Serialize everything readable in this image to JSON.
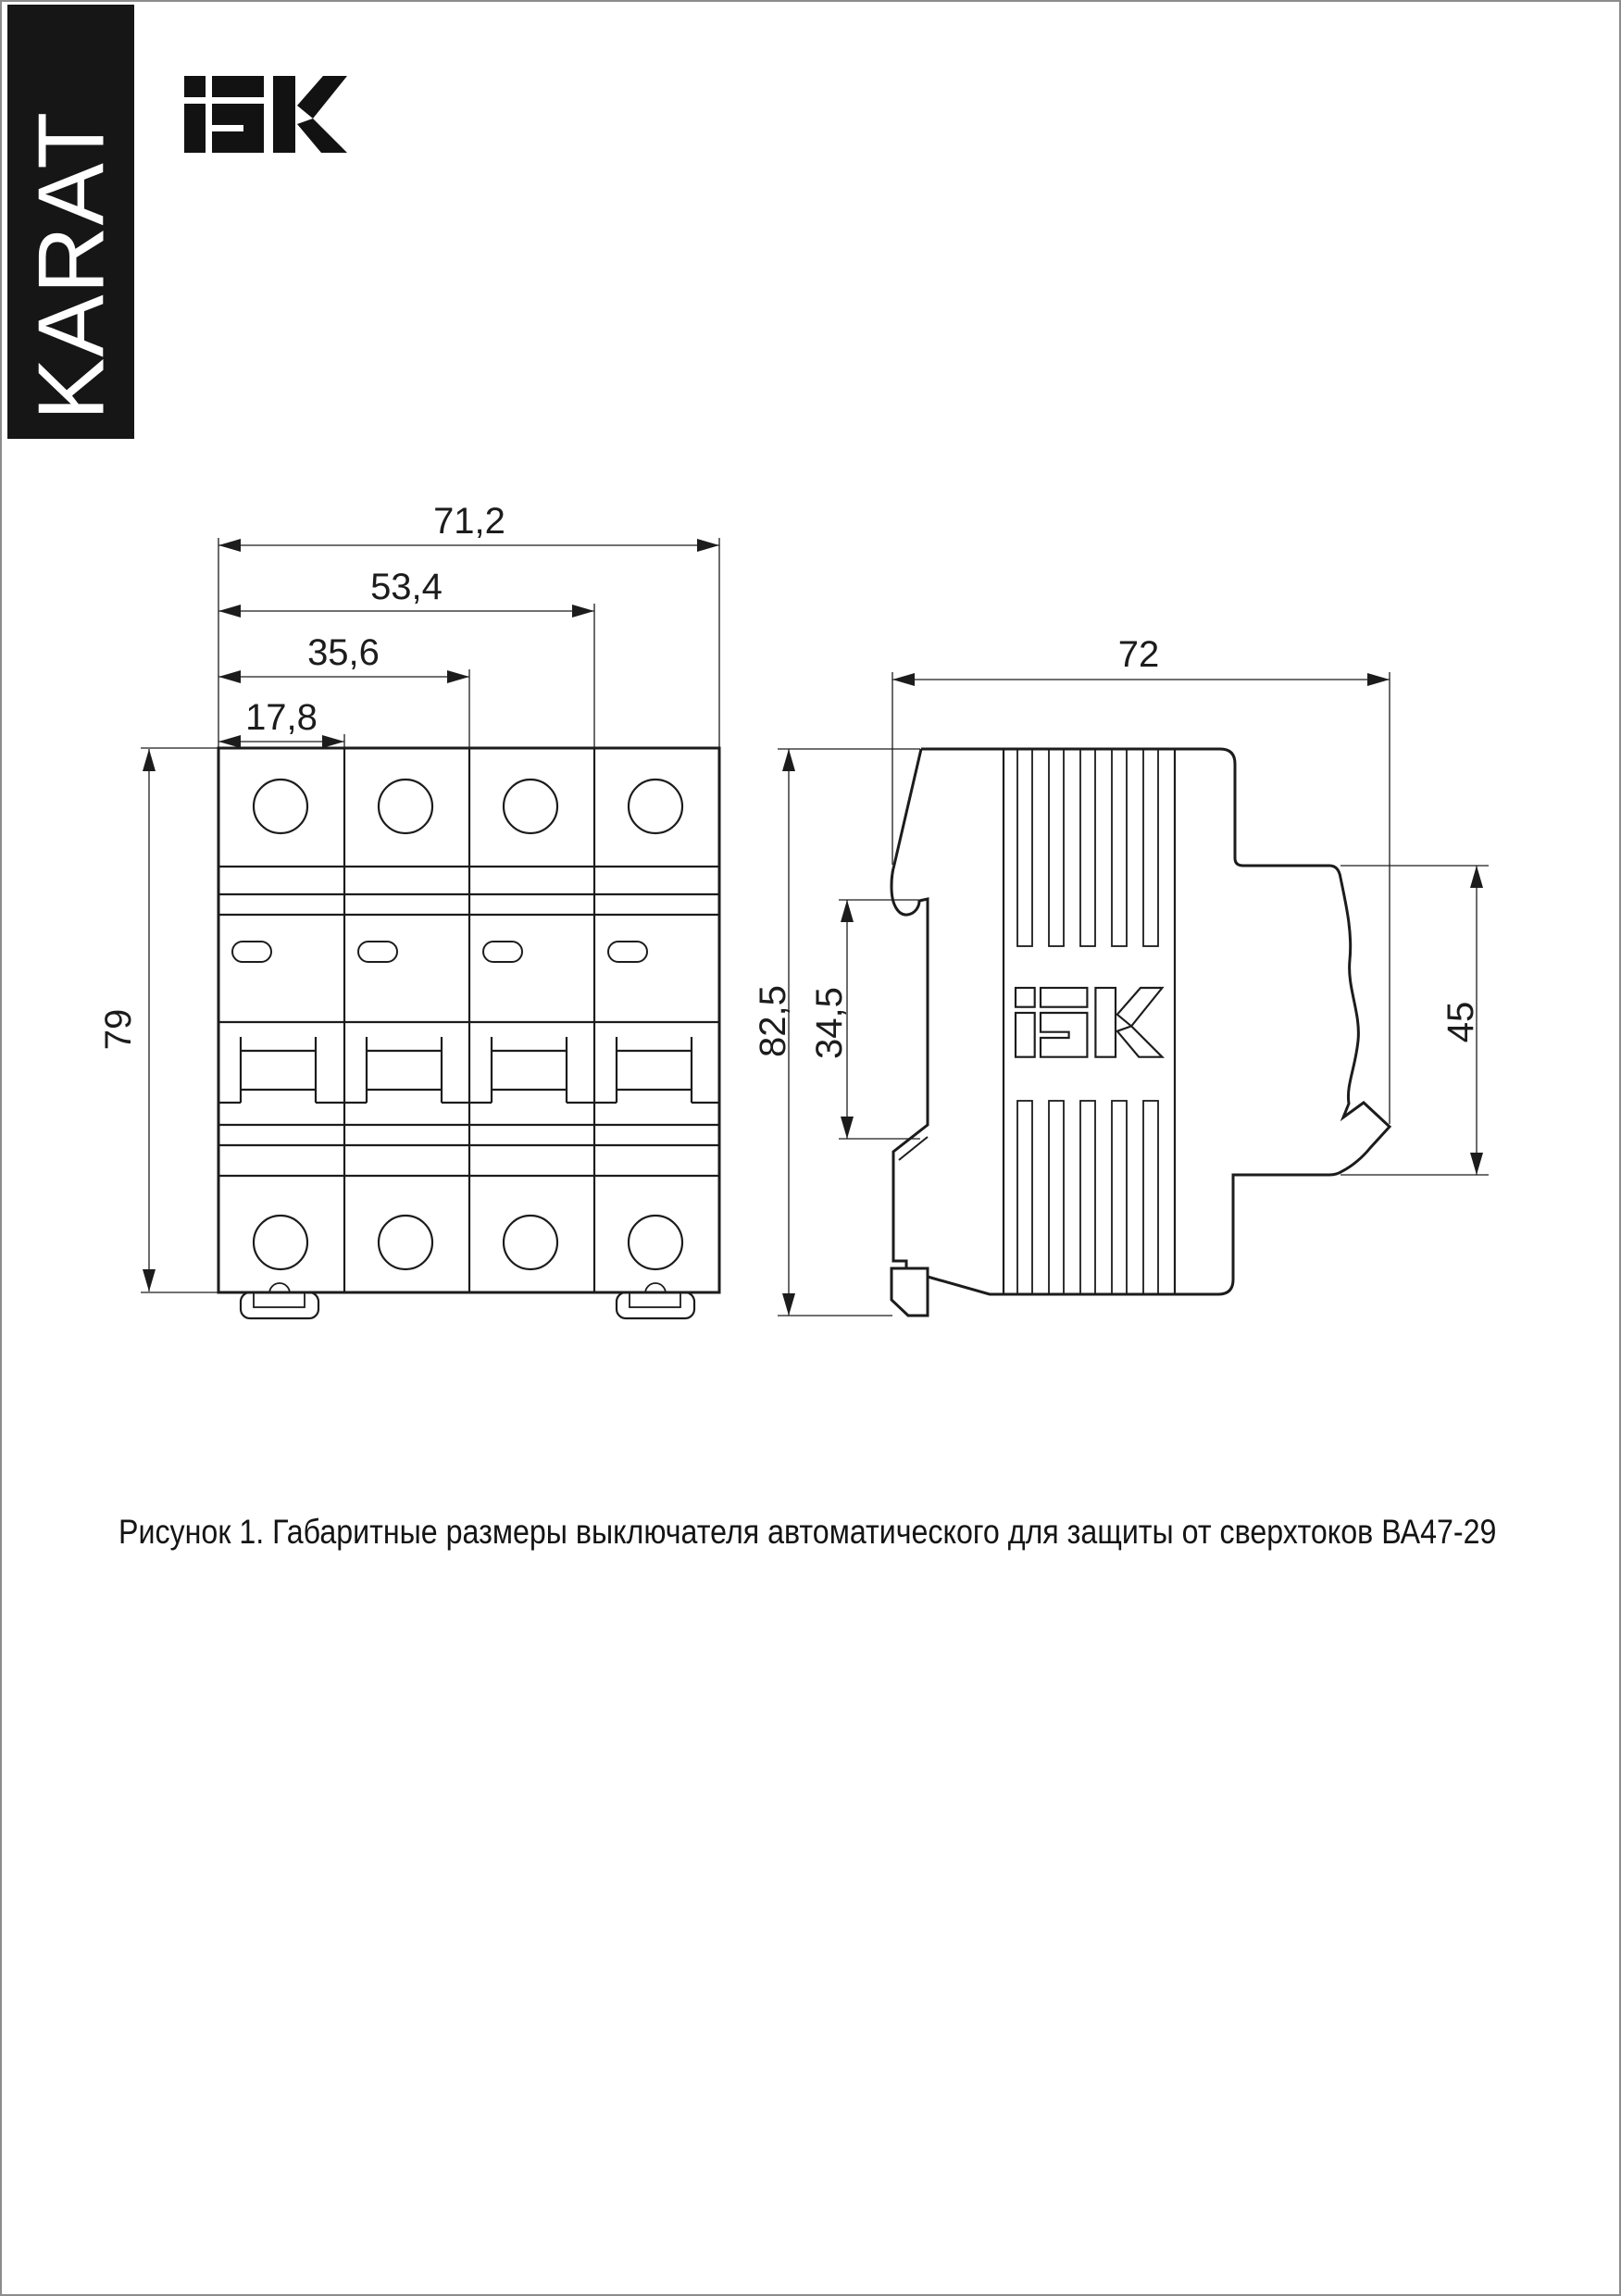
{
  "page": {
    "banner_text": "KARAT",
    "brand": "IEK",
    "caption": "Рисунок 1. Габаритные размеры выключателя автоматического для защиты от сверхтоков ВА47-29"
  },
  "figure": {
    "front_view": {
      "dims": {
        "w_total": "71,2",
        "w_three": "53,4",
        "w_two": "35,6",
        "w_one": "17,8",
        "height": "79"
      }
    },
    "side_view": {
      "dims": {
        "depth": "72",
        "h_total": "82,5",
        "recess": "34,5",
        "mount": "45"
      }
    }
  }
}
